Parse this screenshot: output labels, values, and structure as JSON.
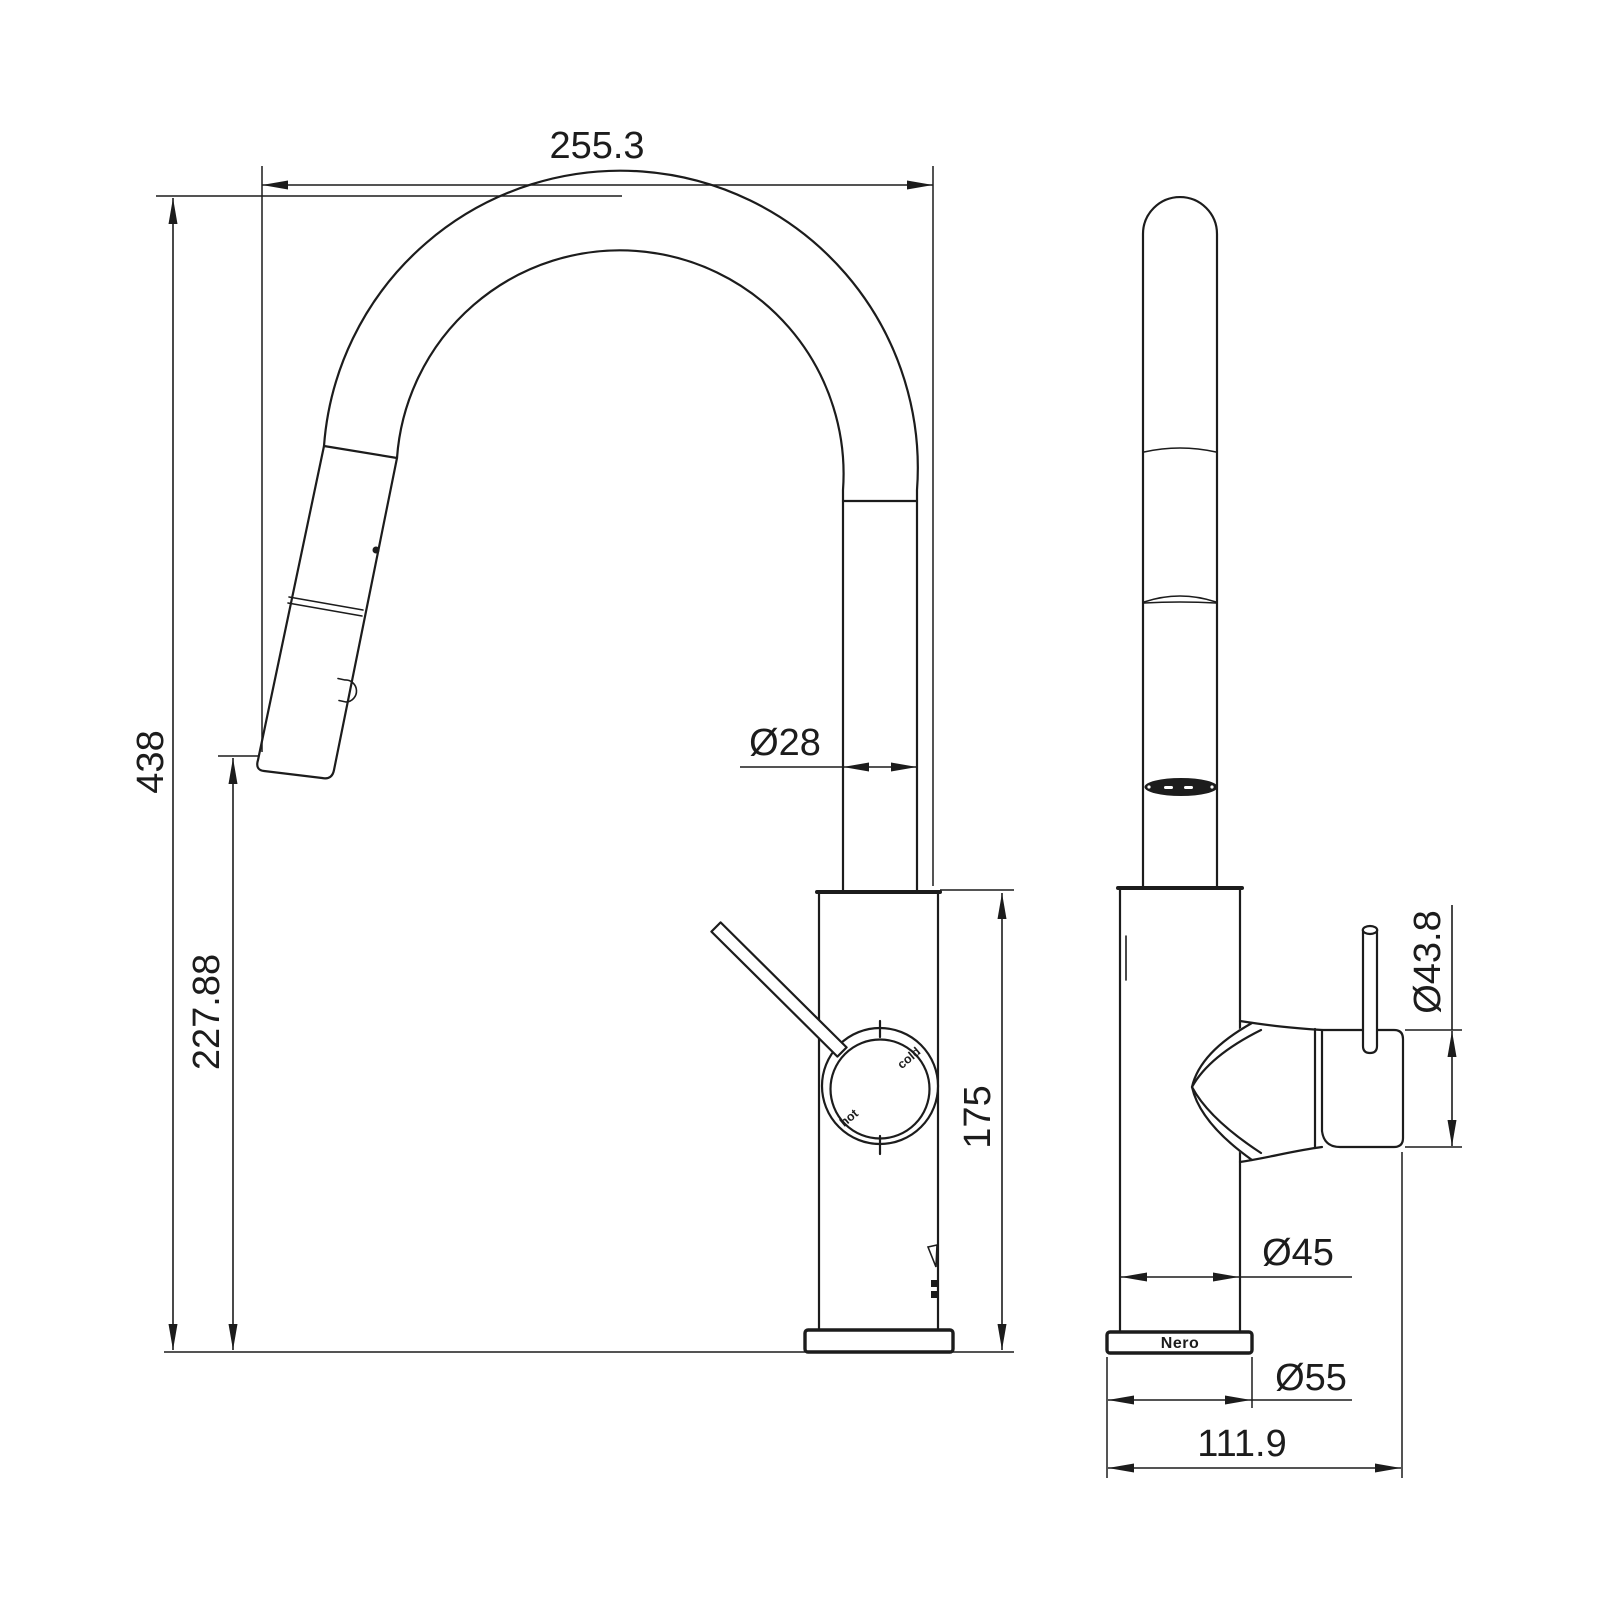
{
  "colors": {
    "background": "#ffffff",
    "line": "#1c1c1c"
  },
  "side_view": {
    "overall_width": "255.3",
    "overall_height": "438",
    "outlet_height": "227.88",
    "spout_diameter": "Ø28",
    "body_height": "175",
    "dial": {
      "hot": "hot",
      "cold": "cold"
    }
  },
  "front_view": {
    "handle_diameter": "Ø43.8",
    "body_diameter": "Ø45",
    "base_diameter": "Ø55",
    "overall_depth": "111.9",
    "brand": "Nero"
  }
}
